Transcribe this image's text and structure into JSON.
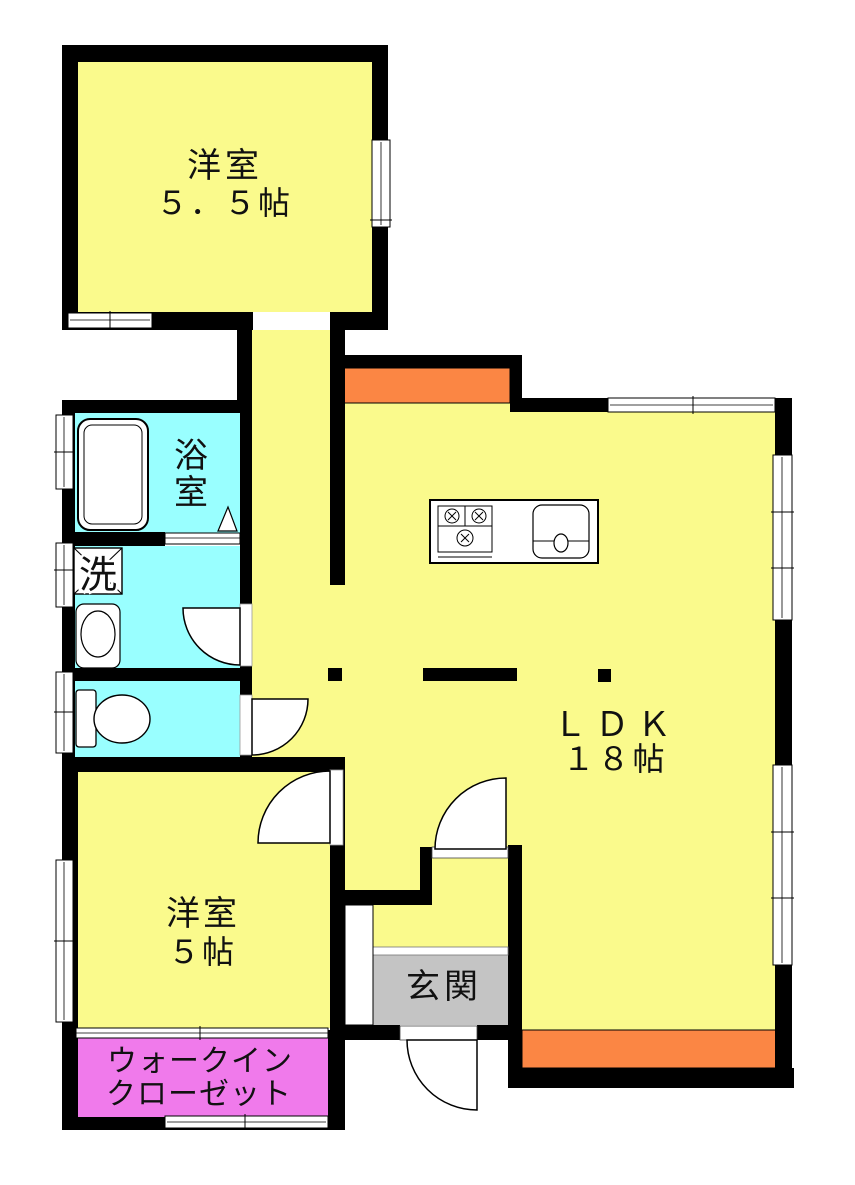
{
  "plan_title": "floor-plan",
  "colors": {
    "wall": "#000000",
    "room_yellow": "#FAFA8C",
    "wet_cyan": "#99FFFF",
    "accent_orange": "#FB8644",
    "closet_magenta": "#F07AEB",
    "entrance_gray": "#C4C4C4",
    "fixture_white": "#FFFFFF"
  },
  "rooms": {
    "bedroom1": {
      "name": "洋室",
      "area": "５．５帖"
    },
    "bedroom2": {
      "name": "洋室",
      "area": "５帖"
    },
    "ldk": {
      "name": "ＬＤＫ",
      "area": "１８帖"
    },
    "bathroom": {
      "name_char1": "浴",
      "name_char2": "室"
    },
    "laundry": {
      "name": "洗"
    },
    "entrance": {
      "name": "玄関"
    },
    "closet": {
      "name_line1": "ウォークイン",
      "name_line2": "クローゼット"
    }
  }
}
